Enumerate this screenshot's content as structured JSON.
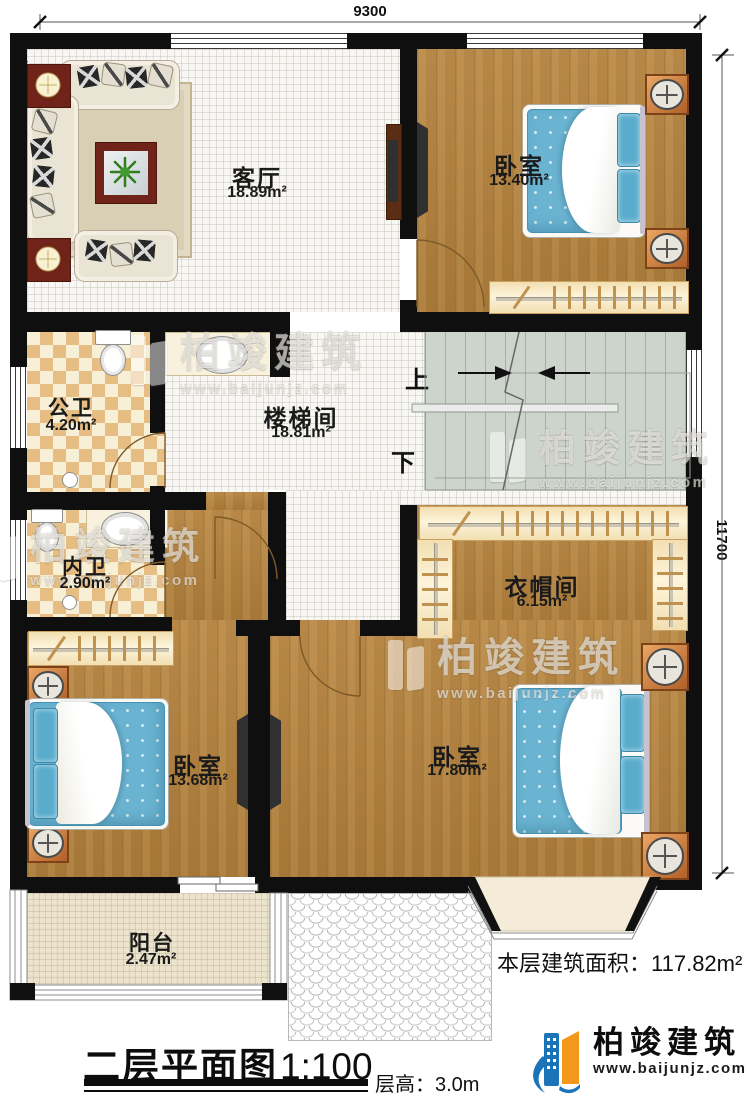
{
  "dimensions": {
    "top": "9300",
    "right": "11700"
  },
  "rooms": {
    "living": {
      "label": "客厅",
      "area": "18.89m²"
    },
    "bedroom_top": {
      "label": "卧室",
      "area": "13.40m²"
    },
    "public_bath": {
      "label": "公卫",
      "area": "4.20m²"
    },
    "stair_hall": {
      "label": "楼梯间",
      "area": "18.81m²"
    },
    "ensuite_bath": {
      "label": "内卫",
      "area": "2.90m²"
    },
    "cloakroom": {
      "label": "衣帽间",
      "area": "6.15m²"
    },
    "bedroom_left": {
      "label": "卧室",
      "area": "13.68m²"
    },
    "bedroom_right": {
      "label": "卧室",
      "area": "17.80m²"
    },
    "balcony": {
      "label": "阳台",
      "area": "2.47m²"
    }
  },
  "stairs": {
    "up": "上",
    "down": "下"
  },
  "summary": {
    "floor_area_label": "本层建筑面积：",
    "floor_area_value": "117.82m²"
  },
  "titleblock": {
    "title": "二层平面图",
    "scale": "1:100",
    "floor_height_label": "层高：",
    "floor_height_value": "3.0m"
  },
  "watermark": {
    "brand": "柏竣建筑",
    "url": "www.baijunjz.com"
  },
  "logo": {
    "brand": "柏竣建筑",
    "url": "www.baijunjz.com"
  },
  "colors": {
    "wall": "#0f0f0f",
    "wood_floor": "#b2803b",
    "bed_blue": "#6ab4d2",
    "brand_blue": "#1b74b8",
    "brand_orange": "#f2991c"
  }
}
